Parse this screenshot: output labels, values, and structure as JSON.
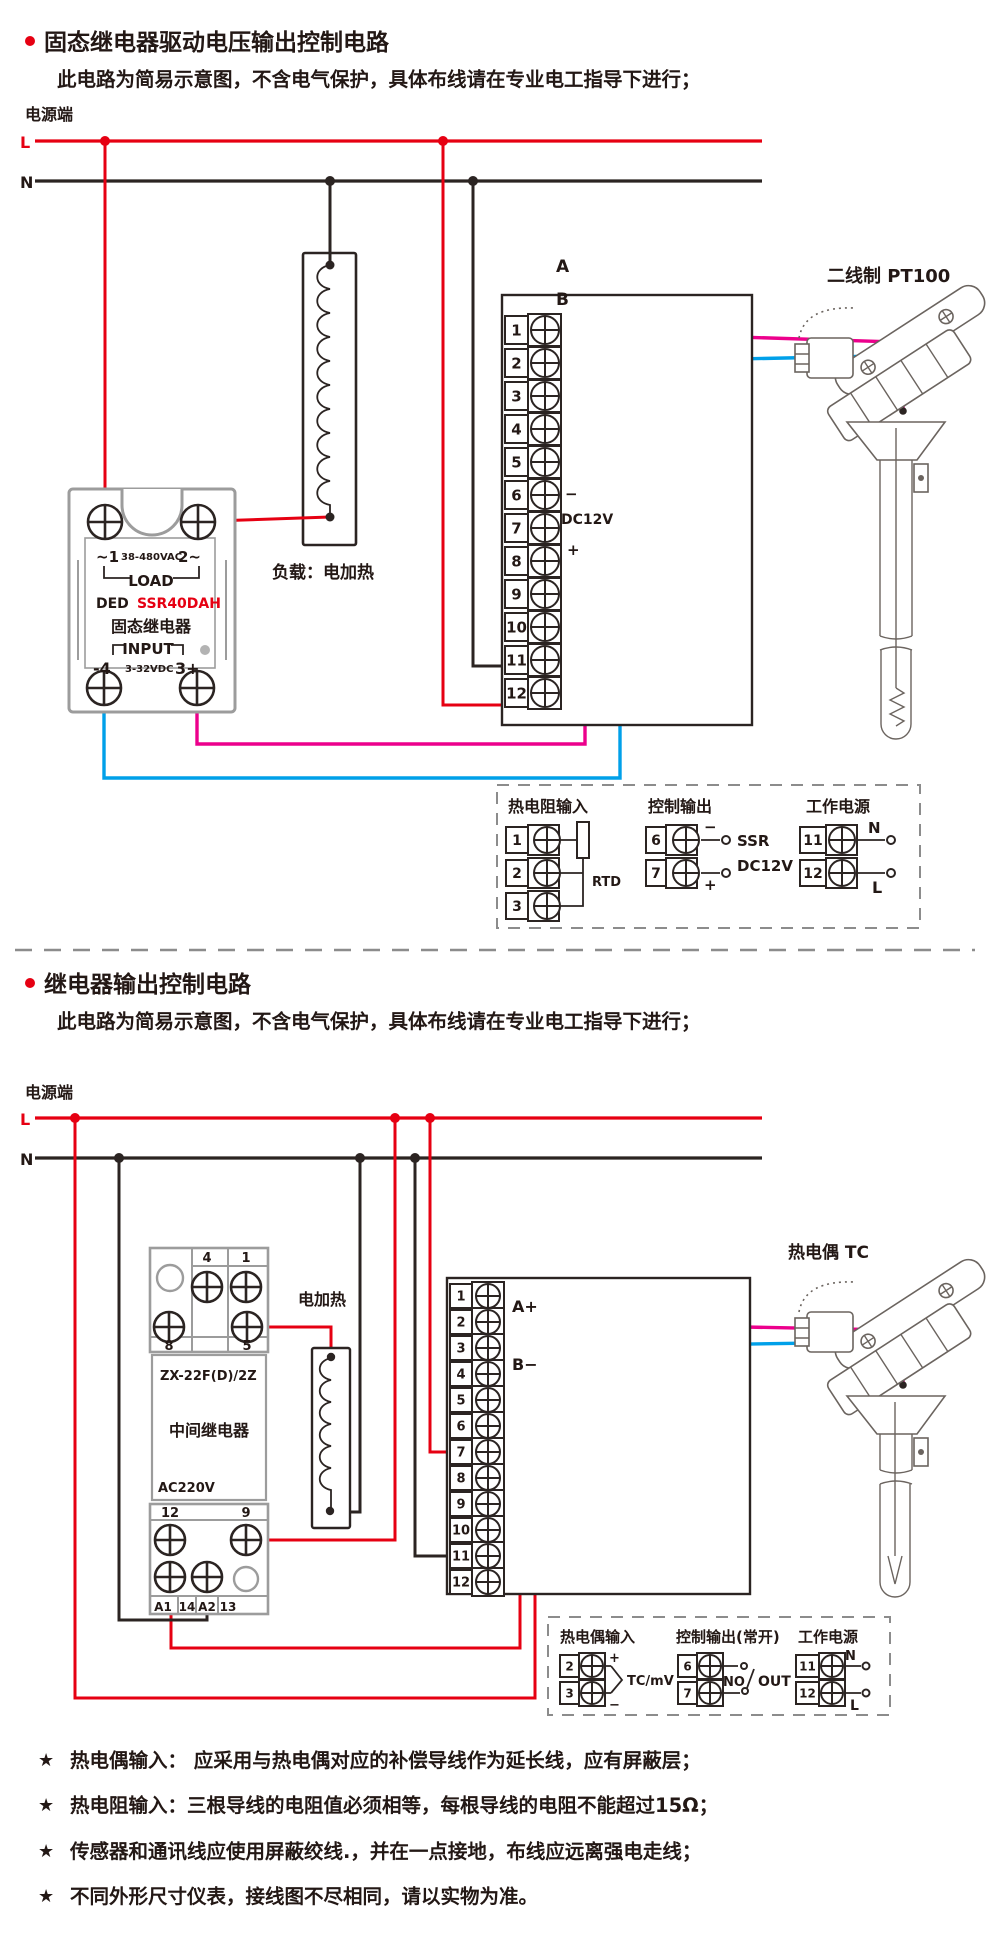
{
  "colors": {
    "red": "#e60012",
    "pink": "#ec008c",
    "blue": "#00a0e9",
    "ink": "#2b2422",
    "gray": "#9c9c9c"
  },
  "section1": {
    "title": "固态继电器驱动电压输出控制电路",
    "subtitle": "此电路为简易示意图，不含电气保护，具体布线请在专业电工指导下进行；",
    "power_label": "电源端",
    "l": "L",
    "n": "N",
    "ssr": {
      "row1_l": "~1",
      "row1_m": "38-480VAC",
      "row1_r": "2~",
      "row2": "LOAD",
      "row3_l": "DED",
      "row3_r": "SSR40DAH",
      "row4": "固态继电器",
      "row5": "INPUT",
      "row6_l": "-4",
      "row6_m": "3-32VDC",
      "row6_r": "3+"
    },
    "load_label": "负载：电加热",
    "instrument": {
      "terminals": [
        "1",
        "2",
        "3",
        "4",
        "5",
        "6",
        "7",
        "8",
        "9",
        "10",
        "11",
        "12"
      ],
      "a": "A",
      "b": "B",
      "minus": "−",
      "dc": "DC12V",
      "plus": "+"
    },
    "sensor_title": "二线制 PT100",
    "legend": {
      "rtd": {
        "title": "热电阻输入",
        "terminals": [
          "1",
          "2",
          "3"
        ],
        "label": "RTD"
      },
      "ctrl": {
        "title": "控制输出",
        "terminals": [
          "6",
          "7"
        ],
        "minus": "−",
        "plus": "+",
        "line1": "SSR",
        "line2": "DC12V"
      },
      "power": {
        "title": "工作电源",
        "terminals": [
          "11",
          "12"
        ],
        "n": "N",
        "l": "L"
      }
    }
  },
  "section2": {
    "title": "继电器输出控制电路",
    "subtitle": "此电路为简易示意图，不含电气保护，具体布线请在专业电工指导下进行；",
    "power_label": "电源端",
    "l": "L",
    "n": "N",
    "relay": {
      "top": [
        "4",
        "1"
      ],
      "mid": [
        "8",
        "5"
      ],
      "model": "ZX-22F(D)/2Z",
      "name": "中间继电器",
      "voltage": "AC220V",
      "low": [
        "12",
        "9"
      ],
      "bottom": [
        "A1",
        "14",
        "A2",
        "13"
      ]
    },
    "heater_label": "电加热",
    "instrument": {
      "terminals": [
        "1",
        "2",
        "3",
        "4",
        "5",
        "6",
        "7",
        "8",
        "9",
        "10",
        "11",
        "12"
      ],
      "a": "A+",
      "b": "B−"
    },
    "sensor_title": "热电偶 TC",
    "legend": {
      "tc": {
        "title": "热电偶输入",
        "terminals": [
          "2",
          "3"
        ],
        "plus": "+",
        "minus": "−",
        "label": "TC/mV"
      },
      "ctrl": {
        "title": "控制输出(常开)",
        "terminals": [
          "6",
          "7"
        ],
        "no": "NO",
        "out": "OUT"
      },
      "power": {
        "title": "工作电源",
        "terminals": [
          "11",
          "12"
        ],
        "n": "N",
        "l": "L"
      }
    }
  },
  "footnotes": [
    {
      "star": "★",
      "text": "热电偶输入： 应采用与热电偶对应的补偿导线作为延长线，应有屏蔽层；"
    },
    {
      "star": "★",
      "text": "热电阻输入：三根导线的电阻值必须相等，每根导线的电阻不能超过15Ω；"
    },
    {
      "star": "★",
      "text": "传感器和通讯线应使用屏蔽绞线.，并在一点接地，布线应远离强电走线；"
    },
    {
      "star": "★",
      "text": "不同外形尺寸仪表，接线图不尽相同，请以实物为准。"
    }
  ]
}
